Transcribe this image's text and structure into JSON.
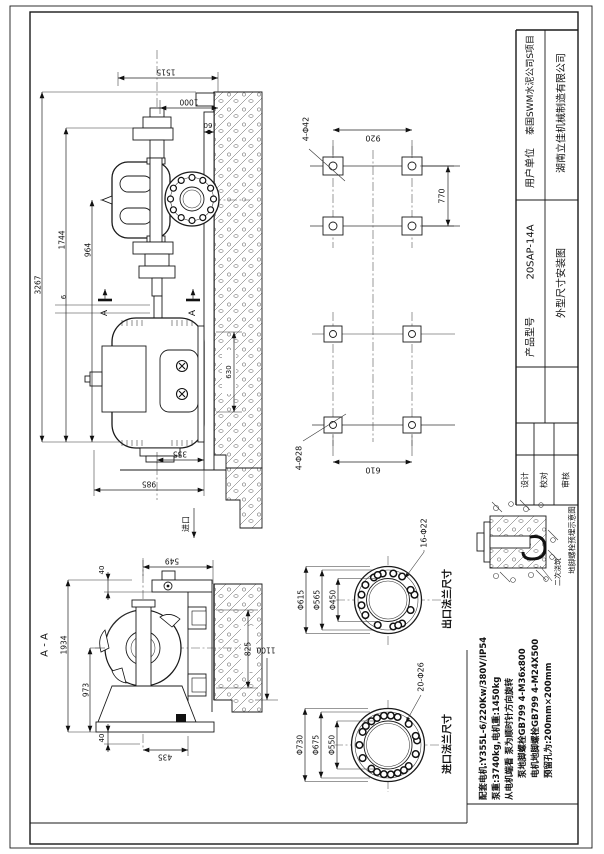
{
  "sheet": {
    "background": "#ffffff",
    "line_color": "#1a1a1a"
  },
  "title_block": {
    "client_label": "用户单位",
    "client": "泰国SWM水泥公司S项目",
    "company": "湖南立佳机械制造有限公司",
    "model_label": "产品型号",
    "model": "20SAP-14A",
    "drawing_title": "外型尺寸安装图",
    "sign_roles": [
      {
        "label": "设计"
      },
      {
        "label": "校对"
      },
      {
        "label": "审核"
      }
    ]
  },
  "notes": [
    {
      "text": "配套电机:Y355L-6/220Kw/380V/IP54"
    },
    {
      "text": "泵重:3740kg,电机重:1450kg"
    },
    {
      "text": "从电机端看 泵为顺时针方向旋转"
    },
    {
      "text": "泵地脚螺栓GB799 4-M36x800"
    },
    {
      "text": "电机地脚螺栓GB799 4-M24X500"
    },
    {
      "text": "预留孔为:200mm×200mm"
    }
  ],
  "views": {
    "side_view": {
      "dims": {
        "overall": "3267",
        "coupling_height": "1744",
        "center_height": "964",
        "pump_top": "1515",
        "top_to_wall": "1000",
        "ledge": "60",
        "gap": "6",
        "block": "630",
        "motor_offset": "355",
        "base_length": "985"
      },
      "labels": {
        "section": "A"
      }
    },
    "foundation_plan": {
      "dims": {
        "span": "920",
        "pump_pitch": "770",
        "motor_span": "610"
      },
      "labels": {
        "pump_bolts": "4-Φ42",
        "motor_bolts": "4-Φ28"
      }
    },
    "section_view": {
      "title": "A - A",
      "dims": {
        "center_to_wall": "549",
        "flange_t": "40",
        "overall": "1934",
        "center_height": "973",
        "base_t": "40",
        "foot": "435",
        "block": "825",
        "depth": "1100"
      },
      "labels": {
        "inlet": "进口"
      }
    },
    "outlet_flange": {
      "caption": "出口法兰尺寸",
      "od": "Φ615",
      "bcd": "Φ565",
      "bore": "Φ450",
      "holes": "16-Φ22"
    },
    "inlet_flange": {
      "caption": "进口法兰尺寸",
      "od": "Φ730",
      "bcd": "Φ675",
      "bore": "Φ550",
      "holes": "20-Φ26"
    },
    "anchor_detail": {
      "caption": "地脚螺栓预埋示意图",
      "grout": "二次浇筑"
    }
  }
}
